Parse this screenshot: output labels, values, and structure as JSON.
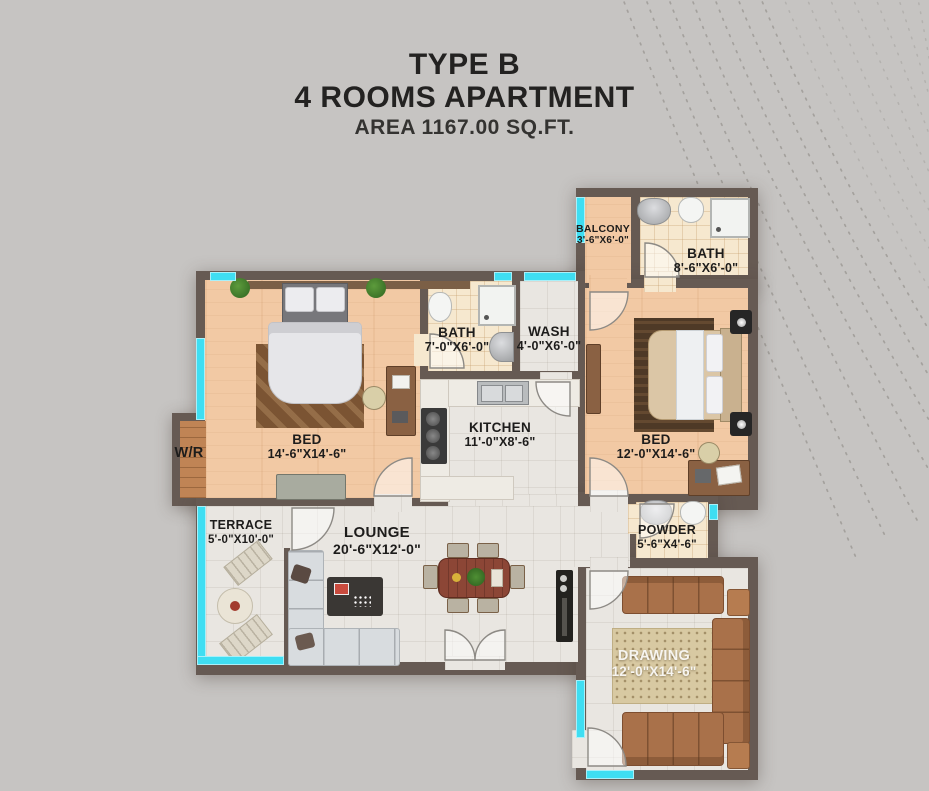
{
  "title": {
    "line1": "TYPE B",
    "line2": "4 ROOMS APARTMENT",
    "line3": "AREA 1167.00 SQ.FT."
  },
  "rooms": {
    "balcony": {
      "name": "BALCONY",
      "dims": "3'-6\"X6'-0\""
    },
    "bath1": {
      "name": "BATH",
      "dims": "8'-6\"X6'-0\""
    },
    "bath2": {
      "name": "BATH",
      "dims": "7'-0\"X6'-0\""
    },
    "wash": {
      "name": "WASH",
      "dims": "4'-0\"X6'-0\""
    },
    "kitchen": {
      "name": "KITCHEN",
      "dims": "11'-0\"X8'-6\""
    },
    "bed1": {
      "name": "BED",
      "dims": "14'-6\"X14'-6\""
    },
    "bed2": {
      "name": "BED",
      "dims": "12'-0\"X14'-6\""
    },
    "wr": {
      "name": "W/R"
    },
    "terrace": {
      "name": "TERRACE",
      "dims": "5'-0\"X10'-0\""
    },
    "lounge": {
      "name": "LOUNGE",
      "dims": "20'-6\"X12'-0\""
    },
    "powder": {
      "name": "POWDER",
      "dims": "5'-6\"X4'-6\""
    },
    "drawing": {
      "name": "DRAWING",
      "dims": "12'-0\"X14'-6\""
    }
  },
  "colors": {
    "bg": "#c6c4c2",
    "wall": "#665a53",
    "win": "#3fdef2",
    "wood": "#f2c9a4",
    "tile": "#f6e8cf",
    "marble": "#e9e6e1",
    "wr": "#c08455",
    "ink": "#232221"
  }
}
